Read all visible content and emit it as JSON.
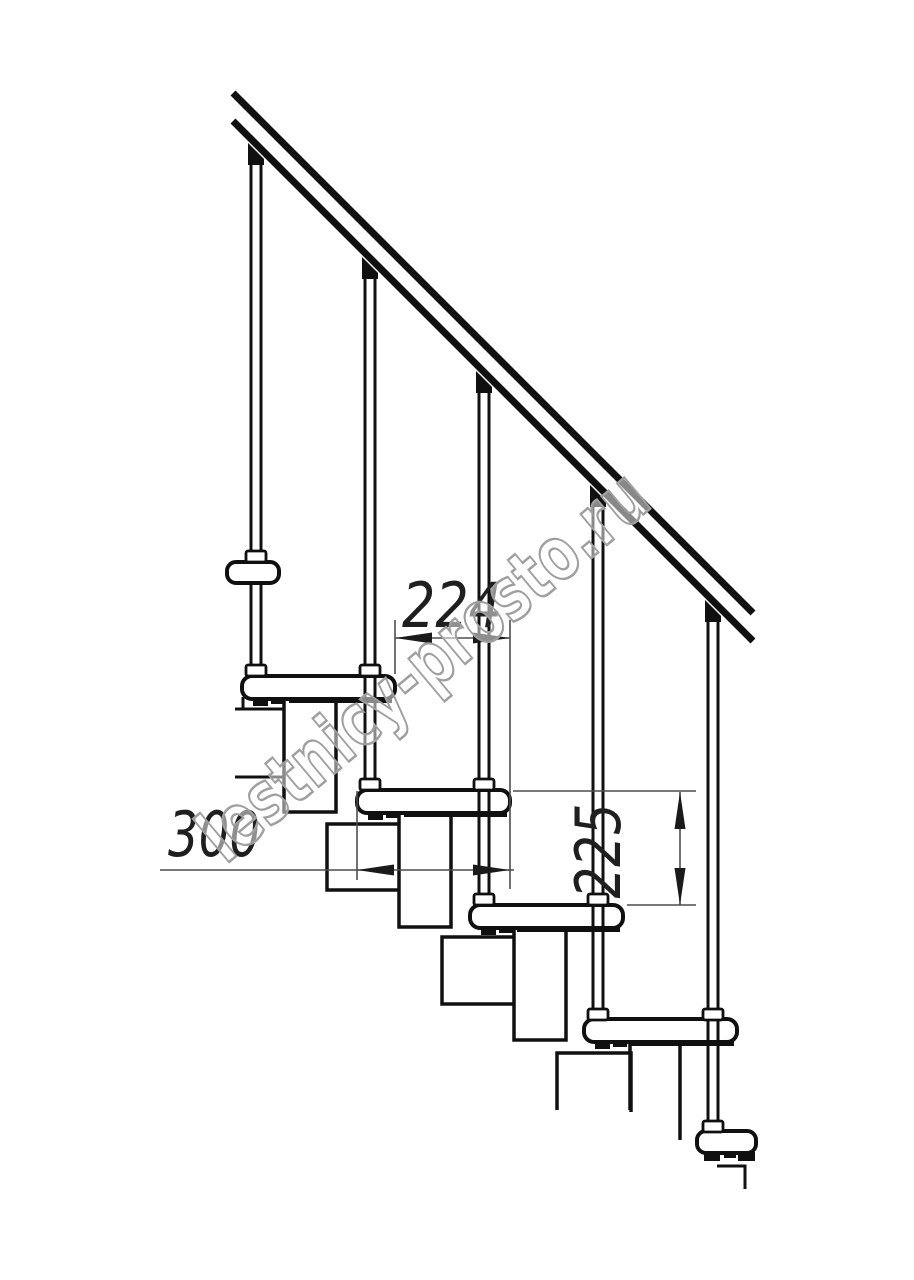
{
  "drawing": {
    "type": "staircase-side-elevation",
    "watermark": "lestnicy-prosto.ru",
    "dimensions": [
      {
        "id": "run",
        "label": "224",
        "orientation": "horizontal"
      },
      {
        "id": "tread-depth",
        "label": "300",
        "orientation": "horizontal"
      },
      {
        "id": "rise",
        "label": "225",
        "orientation": "vertical"
      }
    ],
    "counts": {
      "treads": 6,
      "balusters": 5,
      "support_columns": 4
    },
    "colors": {
      "line": "#101010",
      "dimension_line": "#4d4d4d",
      "dimension_text": "#1f1f1f",
      "watermark_stroke": "#9f9f9f",
      "background": "#ffffff"
    }
  }
}
